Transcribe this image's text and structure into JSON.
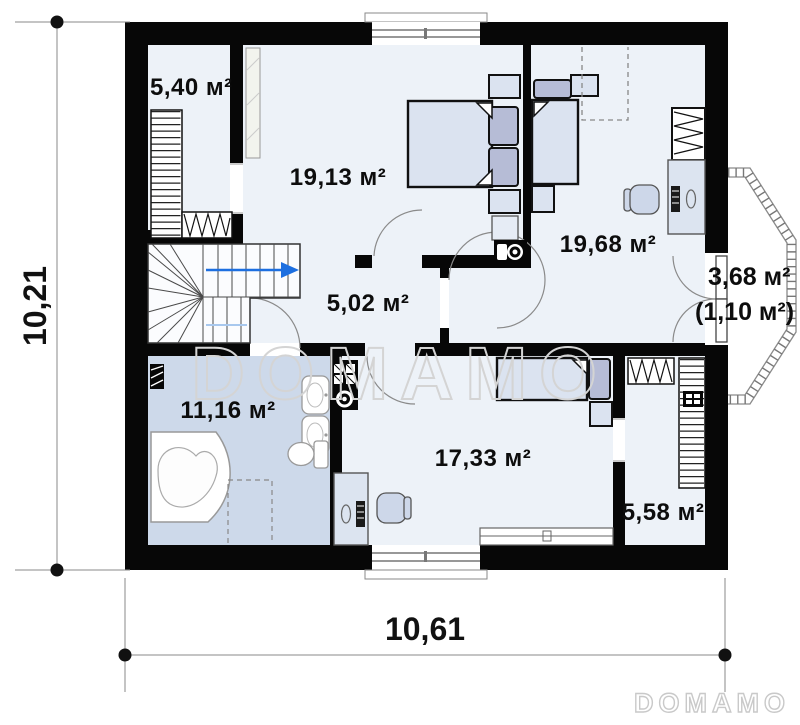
{
  "floor_plan": {
    "rooms": [
      {
        "name": "wardrobe-top",
        "area": "5,40 м²"
      },
      {
        "name": "bedroom-left",
        "area": "19,13 м²"
      },
      {
        "name": "bedroom-right",
        "area": "19,68 м²"
      },
      {
        "name": "hall-stairs",
        "area": "5,02 м²"
      },
      {
        "name": "bathroom",
        "area": "11,16 м²"
      },
      {
        "name": "bedroom-bottom",
        "area": "17,33 м²"
      },
      {
        "name": "wardrobe-bottom",
        "area": "5,58 м²"
      },
      {
        "name": "balcony",
        "area": "3,68 м²",
        "area_alt": "(1,10 м²)"
      }
    ],
    "dimensions": {
      "side": "10,21",
      "front": "10,61"
    },
    "watermark": "DOMAMO",
    "logo": "DOMAMO",
    "colors": {
      "wall": "#070707",
      "room_floor": "#edf2f8",
      "bathroom_floor": "#cdd9ea",
      "furniture": "#dbe3f0",
      "pillow": "#b6bcd6",
      "stair_arrow": "#1d6fe0",
      "watermark_gray": "#d4d4d4"
    }
  }
}
